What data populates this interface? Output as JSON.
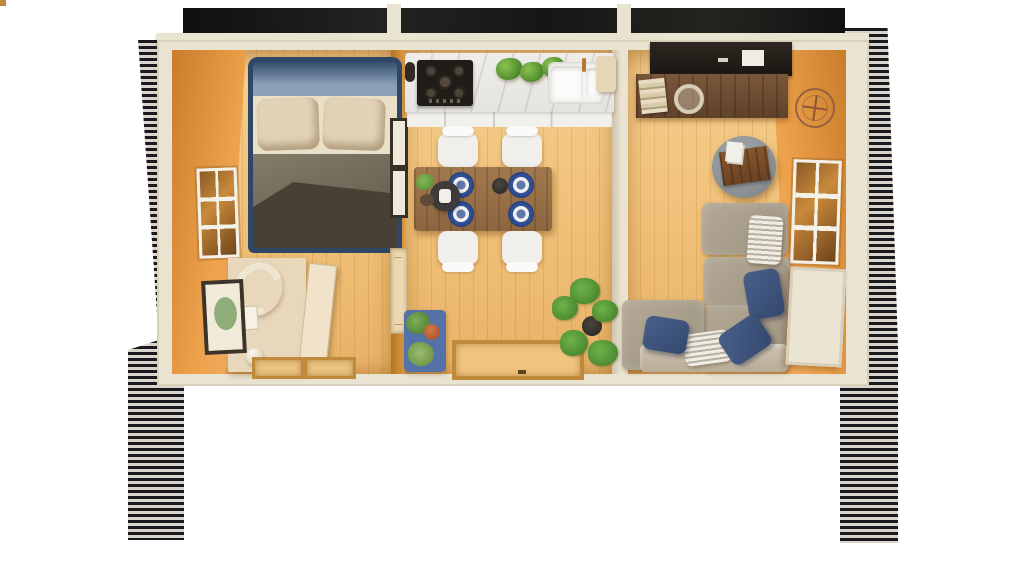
{
  "title": "Top-down cutaway 3D render of a timber cabin interior with porch",
  "scene": {
    "view": "top-down-cutaway-render",
    "rooms": [
      {
        "name": "bedroom",
        "furniture": [
          "double-bed-navy-frame",
          "beige-pillows",
          "grey-duvet",
          "side-window",
          "wardrobe-open-door",
          "leaning-picture-frame",
          "curved-sculpture",
          "yarn-ball",
          "door-thresholds"
        ]
      },
      {
        "name": "kitchen-dining",
        "furniture": [
          "marble-counter",
          "gas-hob-5-burners",
          "double-sink",
          "herb-plants",
          "white-cabinets",
          "dining-table",
          "four-white-chairs",
          "blue-placemats-with-plates",
          "serving-tray",
          "wall-frames",
          "interior-door",
          "blue-plant-mat",
          "entry-mat",
          "monstera-plant"
        ]
      },
      {
        "name": "living-room",
        "furniture": [
          "dark-media-shelf",
          "walnut-desk",
          "book-stack",
          "glass-cup",
          "wire-wall-clock",
          "side-window",
          "round-grey-ottoman-with-wood-tray",
          "magazines",
          "l-shaped-grey-sofa",
          "navy-pillows",
          "striped-cushions",
          "leaning-beach-artwork",
          "door-thresholds"
        ]
      },
      {
        "name": "porch",
        "furniture": [
          "sage-deck-boards",
          "round-rattan-chair-navy-cushion",
          "rattan-sofa-navy-cushion",
          "striped-pillows",
          "rattan-armchair",
          "dark-wicker-ottoman",
          "slatted-railings",
          "deck-steps",
          "posts"
        ]
      }
    ],
    "exterior": [
      "striped-lap-siding-edges",
      "dark-roof-cutaway-band",
      "cream-wall-plates"
    ]
  },
  "colors": {
    "page_bg": "#ffffff",
    "siding_dark": "#1a191d",
    "siding_light": "#d9d5cc",
    "wall_cream": "#e9e3d1",
    "wood_wall": "#eda14b",
    "wood_wall_deep": "#c87827",
    "divider_wood": "#dc9a4a",
    "floor_hi": "#f6cf8e",
    "floor_wood": "#f0c078",
    "bed_navy": "#2f4766",
    "bed_inner": "#8ba1b8",
    "pillow": "#e2d2b6",
    "sheet": "#eadfc7",
    "duvet": "#77705f",
    "wardrobe": "#e8d7ba",
    "cabinet_white": "#f2f0eb",
    "stove_black": "#201d19",
    "chair_white": "#f0efeb",
    "placemat_blue": "#33549c",
    "mat_blue": "#5272a8",
    "deck_green": "#ccd5a7",
    "rail_cream": "#ecdfbd",
    "rattan": "#c59e64",
    "cushion_navy": "#2b3c6b"
  }
}
